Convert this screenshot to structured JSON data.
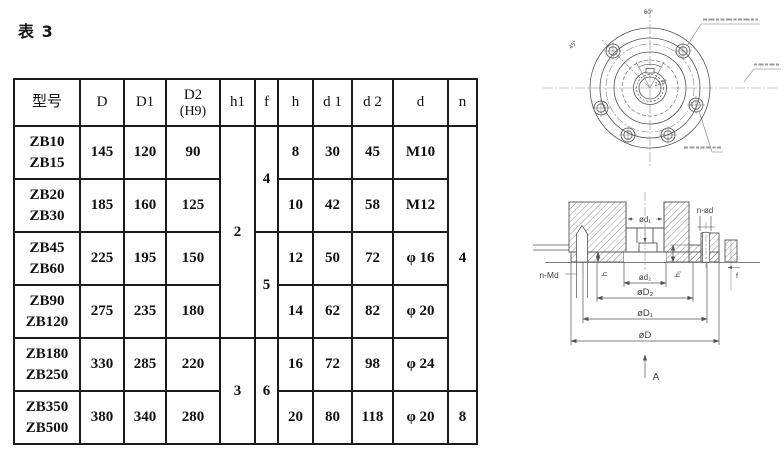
{
  "page": {
    "title": "表 3"
  },
  "table": {
    "headers": {
      "model": "型号",
      "D": "D",
      "D1": "D1",
      "D2": "D2",
      "D2_note": "(H9)",
      "h1": "h1",
      "f": "f",
      "h": "h",
      "d1": "d 1",
      "d2": "d 2",
      "d": "d",
      "n": "n"
    },
    "rows": [
      {
        "m1": "ZB10",
        "m2": "ZB15",
        "D": "145",
        "D1": "120",
        "D2": "90",
        "h": "8",
        "d1": "30",
        "d2": "45",
        "d": "M10"
      },
      {
        "m1": "ZB20",
        "m2": "ZB30",
        "D": "185",
        "D1": "160",
        "D2": "125",
        "h": "10",
        "d1": "42",
        "d2": "58",
        "d": "M12"
      },
      {
        "m1": "ZB45",
        "m2": "ZB60",
        "D": "225",
        "D1": "195",
        "D2": "150",
        "h": "12",
        "d1": "50",
        "d2": "72",
        "d": "φ 16"
      },
      {
        "m1": "ZB90",
        "m2": "ZB120",
        "D": "275",
        "D1": "235",
        "D2": "180",
        "h": "14",
        "d1": "62",
        "d2": "82",
        "d": "φ 20"
      },
      {
        "m1": "ZB180",
        "m2": "ZB250",
        "D": "330",
        "D1": "285",
        "D2": "220",
        "h": "16",
        "d1": "72",
        "d2": "98",
        "d": "φ 24"
      },
      {
        "m1": "ZB350",
        "m2": "ZB500",
        "D": "380",
        "D1": "340",
        "D2": "280",
        "h": "20",
        "d1": "80",
        "d2": "118",
        "d": "φ 20"
      }
    ],
    "merged": {
      "h1_top": "2",
      "h1_bottom": "3",
      "f_top": "4",
      "f_mid": "5",
      "f_bottom": "6",
      "n_top": "4",
      "n_bottom": "8"
    }
  },
  "front_view": {
    "labels": {
      "angle_top": "60°",
      "angle_left": "45°",
      "angle_center": "22.5°"
    }
  },
  "section_view": {
    "labels": {
      "d1": "ød₁",
      "n_od": "n-ød",
      "n_md": "n-Md",
      "h": "h",
      "h1": "h₁",
      "d2": "ød₂",
      "D2": "øD₂",
      "D1": "øD₁",
      "D": "øD",
      "f": "f",
      "A": "A"
    }
  },
  "colors": {
    "line": "#555555",
    "table_border": "#1b1b1b",
    "text": "#111111",
    "annotation": "#9a9a9a"
  }
}
